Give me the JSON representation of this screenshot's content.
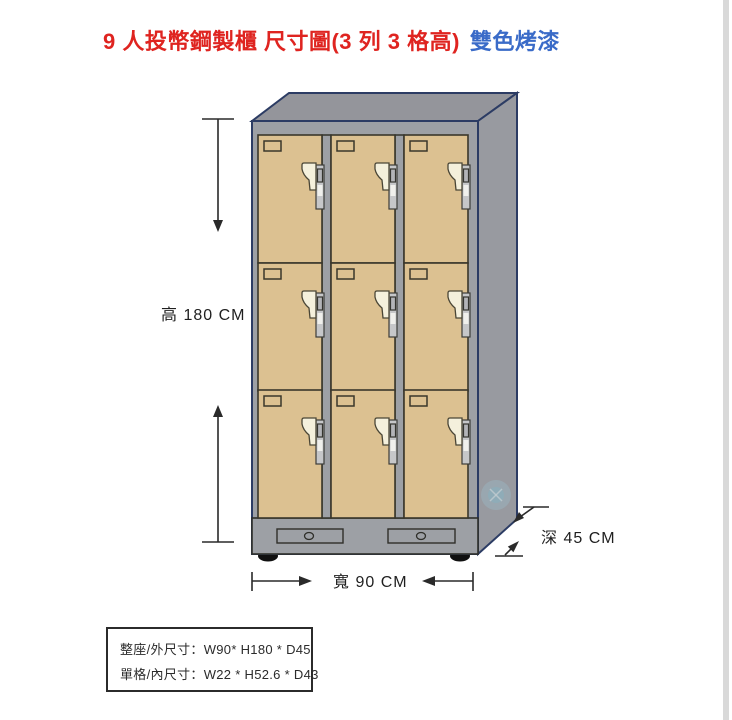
{
  "title": {
    "main": "9 人投幣鋼製櫃 尺寸圖(3 列 3 格高)",
    "suffix": "雙色烤漆"
  },
  "dimensions": {
    "height": "高 180 CM",
    "width": "寬 90 CM",
    "depth": "深 45 CM"
  },
  "spec_box": {
    "line1": "整座/外尺寸：W90* H180 * D45",
    "line2": "單格/內尺寸：W22 * H52.6 * D43"
  },
  "locker": {
    "rows": 3,
    "columns": 3,
    "doors": 9
  },
  "colors": {
    "title-red": "#df2420",
    "title-blue": "#3a6bc8",
    "door": "#dcc191",
    "door-outline": "#3a372b",
    "frame": "#9da0a5",
    "top-face": "#94959b",
    "side-face": "#989aa0",
    "navy": "#2c3c64",
    "cream": "#f4f0dc",
    "lock-gray": "#c6c7c9",
    "dim": "#2a2a2a",
    "foot": "#101010",
    "watermark": "#9fd8e8",
    "scroll": "#d9d9d9"
  }
}
